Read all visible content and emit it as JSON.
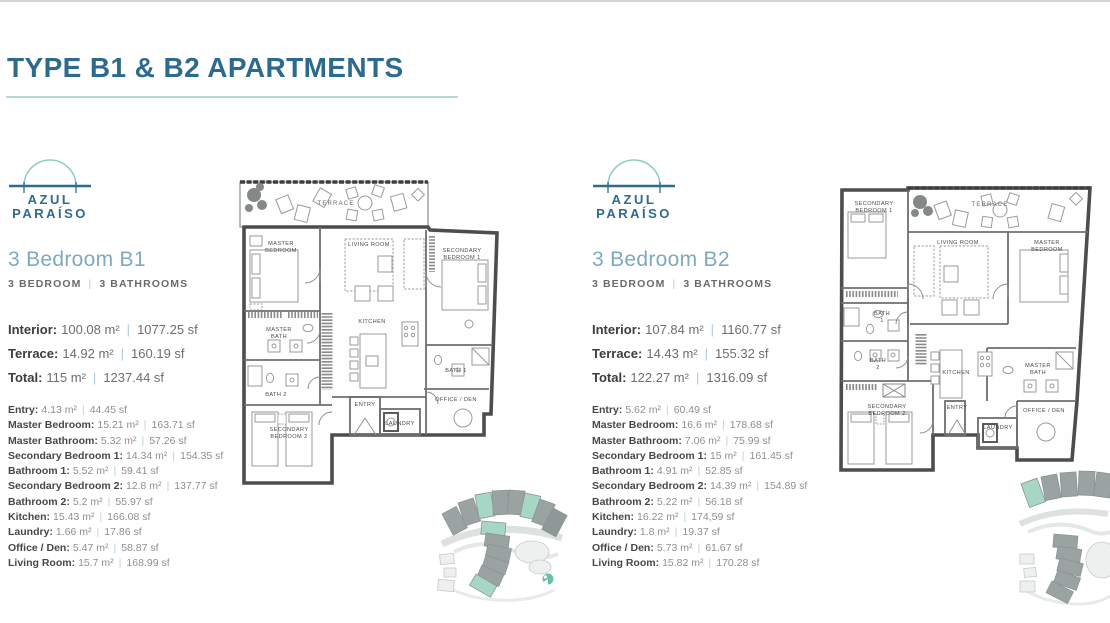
{
  "page": {
    "title": "TYPE B1 & B2 APARTMENTS"
  },
  "sep_char": "|",
  "brand": {
    "line1": "AZUL",
    "line2": "PARAÍSO"
  },
  "units": [
    {
      "heading": "3 Bedroom B1",
      "subtitle_bedrooms": "3 BEDROOM",
      "subtitle_bathrooms": "3 BATHROOMS",
      "summary": [
        {
          "label": "Interior:",
          "m2": "100.08 m²",
          "sf": "1077.25 sf"
        },
        {
          "label": "Terrace:",
          "m2": "14.92 m²",
          "sf": "160.19 sf"
        },
        {
          "label": "Total:",
          "m2": "115 m²",
          "sf": "1237.44 sf"
        }
      ],
      "rooms": [
        {
          "label": "Entry:",
          "m2": "4.13 m²",
          "sf": "44.45 sf"
        },
        {
          "label": "Master Bedroom:",
          "m2": "15.21 m²",
          "sf": "163.71 sf"
        },
        {
          "label": "Master Bathroom:",
          "m2": "5.32 m²",
          "sf": "57.26 sf"
        },
        {
          "label": "Secondary Bedroom 1:",
          "m2": "14.34 m²",
          "sf": "154.35 sf"
        },
        {
          "label": "Bathroom 1:",
          "m2": "5.52 m²",
          "sf": "59.41 sf"
        },
        {
          "label": "Secondary Bedroom 2:",
          "m2": "12.8 m²",
          "sf": "137.77 sf"
        },
        {
          "label": "Bathroom 2:",
          "m2": "5.2 m²",
          "sf": "55.97 sf"
        },
        {
          "label": "Kitchen:",
          "m2": "15.43 m²",
          "sf": "166.08 sf"
        },
        {
          "label": "Laundry:",
          "m2": "1.66 m²",
          "sf": "17.86 sf"
        },
        {
          "label": "Office / Den:",
          "m2": "5.47 m²",
          "sf": "58.87 sf"
        },
        {
          "label": "Living Room:",
          "m2": "15.7 m²",
          "sf": "168.99 sf"
        }
      ],
      "plan": {
        "terrace": "TERRACE",
        "master_bedroom": [
          "MASTER",
          "BEDROOM"
        ],
        "living_room": "LIVING ROOM",
        "secondary_bedroom_1": [
          "SECONDARY",
          "BEDROOM 1"
        ],
        "master_bath": [
          "MASTER",
          "BATH"
        ],
        "bath_2": "BATH 2",
        "kitchen": "KITCHEN",
        "bath_1": "BATH 1",
        "office_den": "OFFICE / DEN",
        "secondary_bedroom_2": [
          "SECONDARY",
          "BEDROOM 2"
        ],
        "entry": "ENTRY",
        "laundry": "LAUNDRY"
      }
    },
    {
      "heading": "3 Bedroom B2",
      "subtitle_bedrooms": "3 BEDROOM",
      "subtitle_bathrooms": "3 BATHROOMS",
      "summary": [
        {
          "label": "Interior:",
          "m2": "107.84 m²",
          "sf": "1160.77 sf"
        },
        {
          "label": "Terrace:",
          "m2": "14.43 m²",
          "sf": "155.32 sf"
        },
        {
          "label": "Total:",
          "m2": "122.27 m²",
          "sf": "1316.09 sf"
        }
      ],
      "rooms": [
        {
          "label": "Entry:",
          "m2": "5.62 m²",
          "sf": "60.49 sf"
        },
        {
          "label": "Master Bedroom:",
          "m2": "16.6 m²",
          "sf": "178.68 sf"
        },
        {
          "label": "Master Bathroom:",
          "m2": "7.06 m²",
          "sf": "75.99 sf"
        },
        {
          "label": "Secondary Bedroom 1:",
          "m2": "15 m²",
          "sf": "161.45 sf"
        },
        {
          "label": "Bathroom 1:",
          "m2": "4.91 m²",
          "sf": "52.85 sf"
        },
        {
          "label": "Secondary Bedroom 2:",
          "m2": "14.39 m²",
          "sf": "154.89 sf"
        },
        {
          "label": "Bathroom 2:",
          "m2": "5.22 m²",
          "sf": "56.18 sf"
        },
        {
          "label": "Kitchen:",
          "m2": "16.22 m²",
          "sf": "174,59 sf"
        },
        {
          "label": "Laundry:",
          "m2": "1.8 m²",
          "sf": "19.37 sf"
        },
        {
          "label": "Office / Den:",
          "m2": "5.73 m²",
          "sf": "61.67 sf"
        },
        {
          "label": "Living Room:",
          "m2": "15.82 m²",
          "sf": "170.28 sf"
        }
      ],
      "plan": {
        "secondary_bedroom_1": [
          "SECONDARY",
          "BEDROOM 1"
        ],
        "terrace": "TERRACE",
        "living_room": "LIVING ROOM",
        "master_bedroom": [
          "MASTER",
          "BEDROOM"
        ],
        "bath_1": [
          "BATH",
          "1"
        ],
        "bath_2": [
          "BATH",
          "2"
        ],
        "kitchen": "KITCHEN",
        "master_bath": [
          "MASTER",
          "BATH"
        ],
        "secondary_bedroom_2": [
          "SECONDARY",
          "BEDROOM 2"
        ],
        "entry": "ENTRY",
        "laundry": "LAUNDRY",
        "office_den": "OFFICE / DEN"
      }
    }
  ],
  "colors": {
    "title_blue": "#2d6b8e",
    "underline_mint": "#b5dcca",
    "heading_blue": "#7fa9c0",
    "logo_arc_teal": "#8fcfba",
    "map_teal": "#a6d7c4",
    "map_gray": "#9aa3a2",
    "dot_teal": "#66c2a3"
  }
}
